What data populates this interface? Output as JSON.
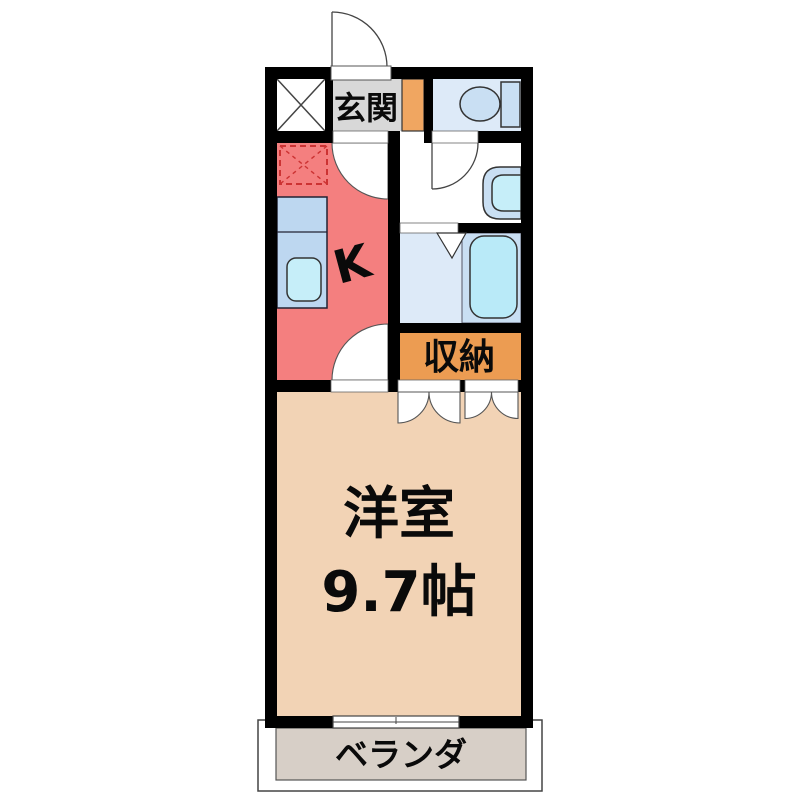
{
  "rooms": {
    "entrance": {
      "label": "玄関"
    },
    "kitchen": {
      "label": "K"
    },
    "storage": {
      "label": "収納"
    },
    "western_room": {
      "label": "洋室",
      "size": "9.7帖"
    },
    "veranda": {
      "label": "ベランダ"
    }
  },
  "colors": {
    "wall": "#000000",
    "entrance_floor": "#D8D8D8",
    "shoe_cabinet": "#F0A661",
    "storage_floor": "#EC9C52",
    "kitchen_floor": "#F47F7F",
    "kitchen_counter": "#BDD7F0",
    "kitchen_sink": "#C6EEF9",
    "toilet_room_floor": "#DDEAF8",
    "fixture_blue": "#C9DFF3",
    "bath_floor": "#DDEAF8",
    "bathtub": "#B9EAF8",
    "room_floor": "#F2D3B5",
    "veranda_floor": "#D7CFC7",
    "refrigerator_dash": "#CC3333",
    "door_swing_white": "#FFFFFF"
  },
  "icons": {
    "toilet": "toilet-icon",
    "bathtub": "bathtub-icon",
    "washbasin": "washbasin-icon",
    "kitchen_sink": "kitchen-sink-icon",
    "refrigerator_space": "refrigerator-space-icon",
    "pipe_space": "pipe-space-x-icon",
    "door_swing": "door-swing-arc-icon",
    "folding_door": "folding-door-icon",
    "sliding_window": "sliding-window-icon"
  }
}
